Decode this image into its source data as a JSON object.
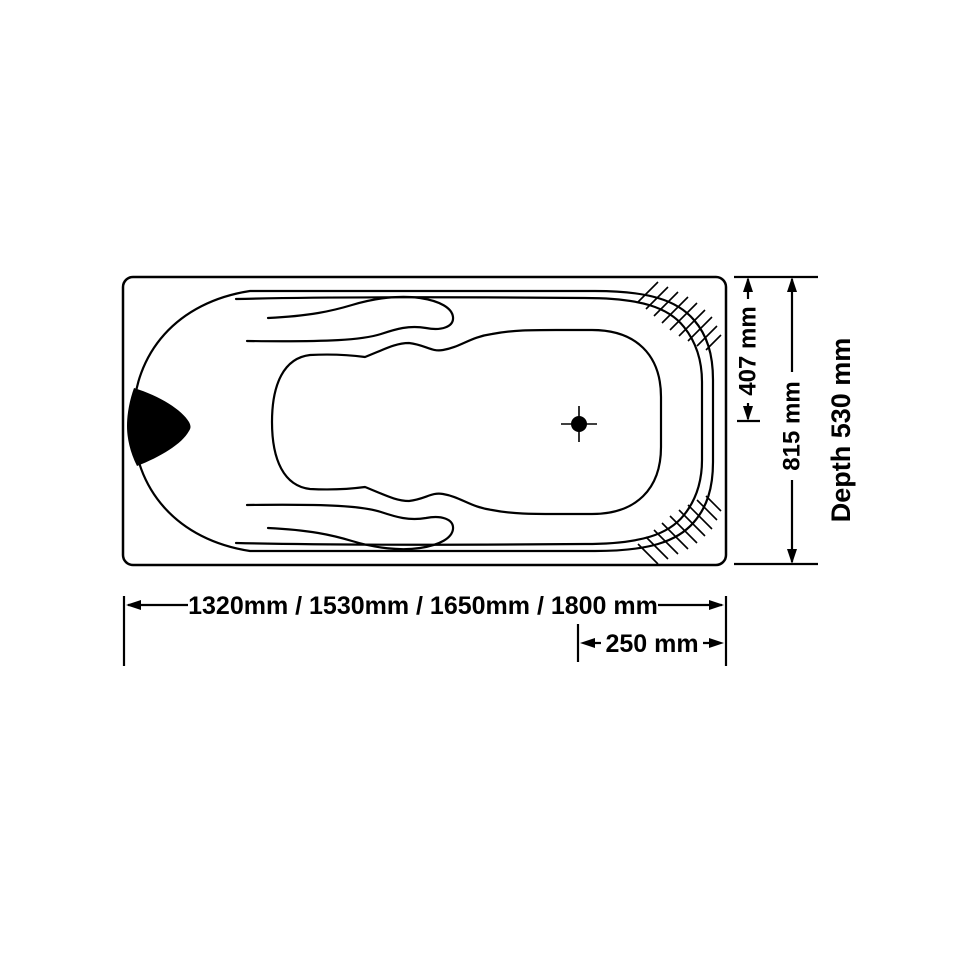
{
  "page": {
    "background": "#ffffff",
    "ink_color": "#000000"
  },
  "drawing": {
    "type": "technical-diagram",
    "subject": "bathtub top view with contoured basin, headrest pillow, drain marker and dimension lines",
    "labels": {
      "width_to_drain_centerline": "407 mm",
      "overall_width": "815 mm",
      "depth": "Depth 530 mm",
      "available_lengths": "1320mm / 1530mm / 1650mm / 1800 mm",
      "drain_to_end": "250 mm"
    }
  }
}
